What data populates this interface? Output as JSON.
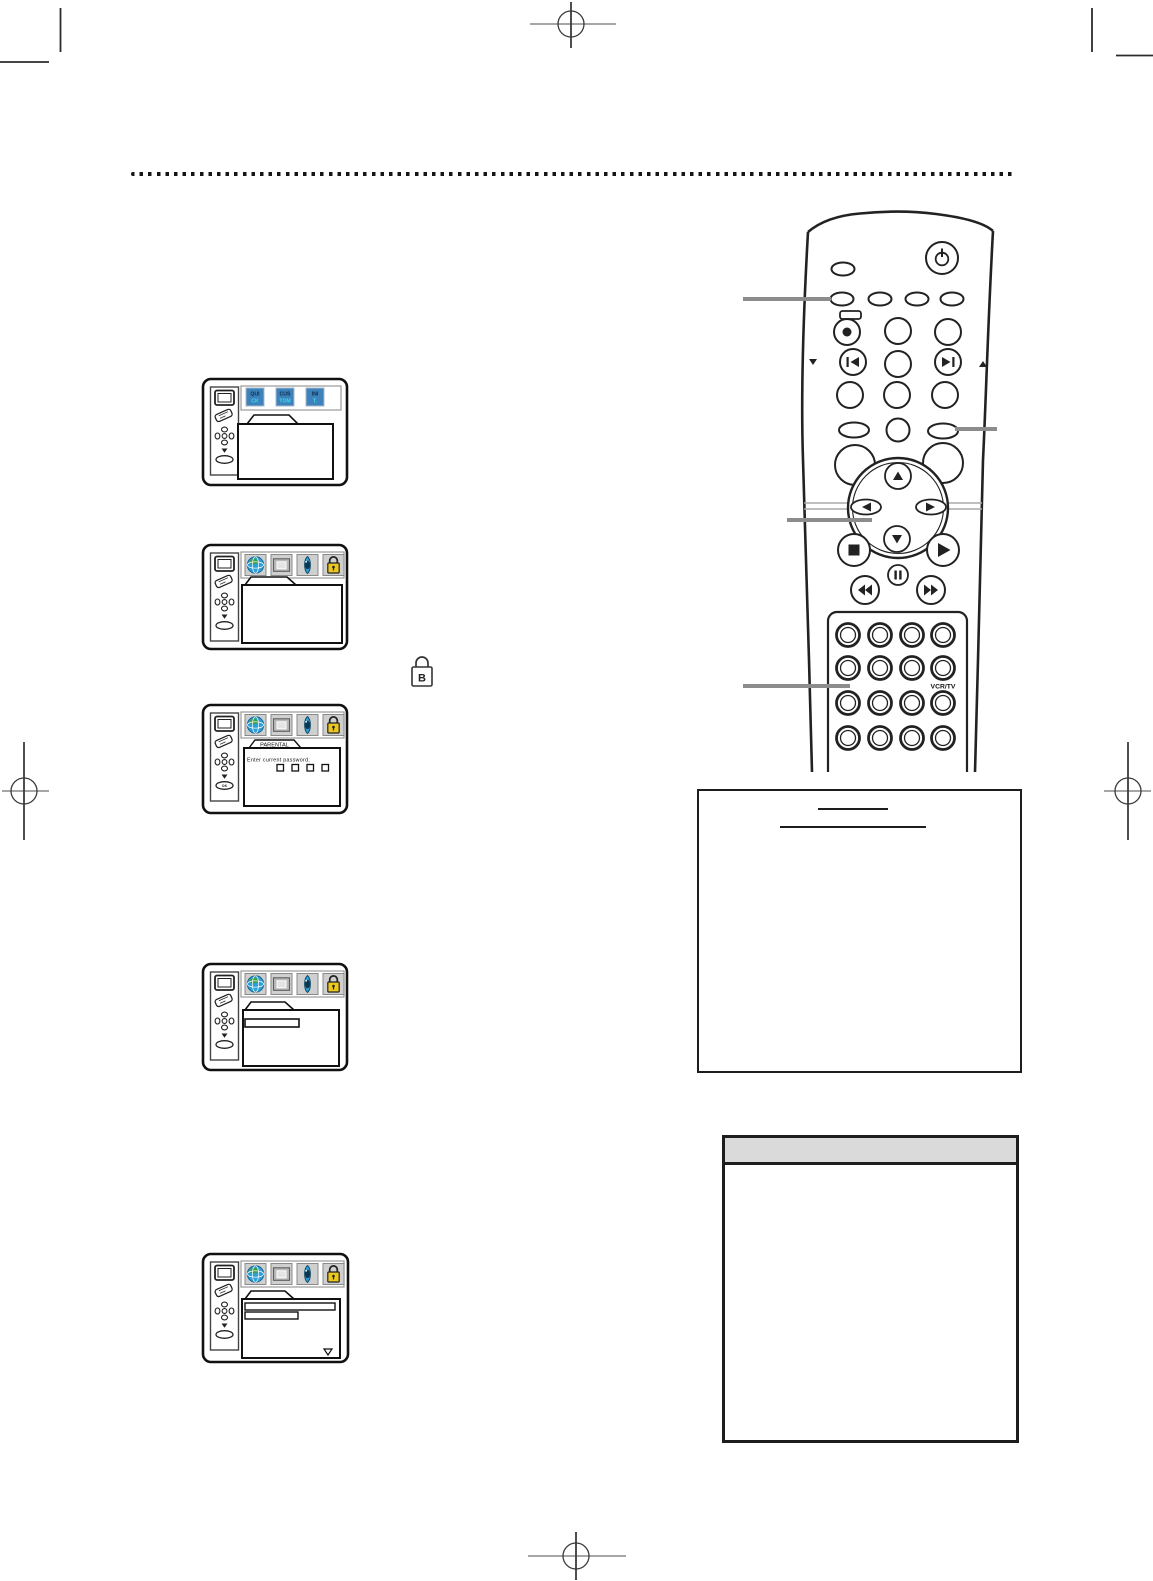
{
  "page": {
    "background": "#ffffff",
    "type_hint": "vcr-manual-page-graphics"
  },
  "osd_screens": {
    "quick_tab": {
      "line1": "QUI",
      "line2": "CK"
    },
    "custom_tab": {
      "line1": "CUS",
      "line2": "TOM"
    },
    "init_tab": {
      "line1": "INI",
      "line2": "T."
    },
    "parental": {
      "tab_label": "PARENTAL",
      "prompt": "Enter current password.",
      "password_boxes": 4
    },
    "ok_button_label": "OK"
  },
  "remote": {
    "vcr_tv_label": "VCR/TV",
    "number_pad_rows": 4,
    "number_pad_cols": 4
  },
  "inline_lock_glyph": "B",
  "icons": {
    "osd_menu_bar": [
      "globe-icon",
      "display-icon",
      "eye-icon",
      "padlock-icon"
    ],
    "osd_sidebar": [
      "tv-icon",
      "remote-icon",
      "nav-cross-icon",
      "down-triangle-icon",
      "select-oval-icon"
    ],
    "remote_buttons": [
      "power-icon",
      "record-icon",
      "prev-track-icon",
      "next-track-icon",
      "up-icon",
      "down-icon",
      "left-icon",
      "right-icon",
      "stop-icon",
      "play-icon",
      "pause-icon",
      "rewind-icon",
      "fast-forward-icon"
    ]
  },
  "colors": {
    "osd_blue": "#2da0d8",
    "osd_tab_blue": "#3e82bc",
    "lock_yellow": "#ecc91c",
    "note_header_gray": "#dadada",
    "callout_gray": "#8c8c8c",
    "ink": "#1d1d1d"
  }
}
